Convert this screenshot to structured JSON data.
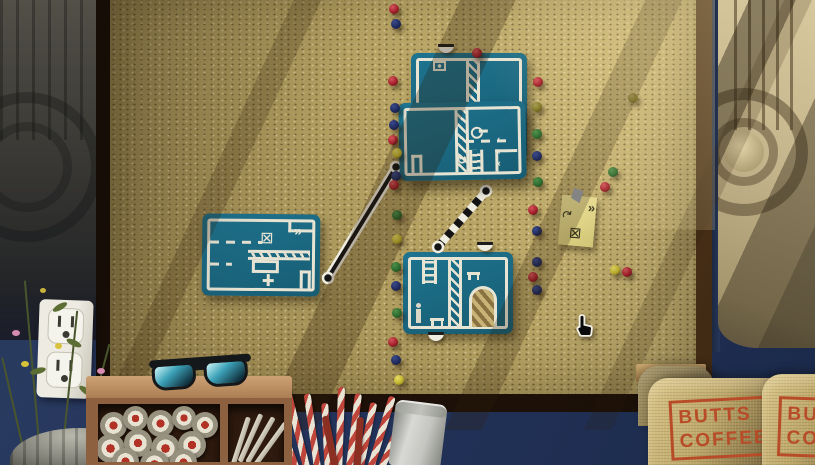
{
  "scene": {
    "name": "corkboard-mission-select",
    "cursor": {
      "x": 572,
      "y": 313,
      "type": "hand-pointer"
    }
  },
  "colors": {
    "cork": "#b8a565",
    "card_teal": "#1b6a83",
    "card_line": "#e8e4d4",
    "wall_navy": "#25355e",
    "frame_wood_dark": "#1a0f07",
    "frame_wood_light": "#6b4a26",
    "note_yellow": "#e6db8e",
    "stamp_red": "#b84c28",
    "pin_red": "#a8222c",
    "pin_blue": "#1f2a5e",
    "pin_green": "#2c6b2f",
    "pin_yellow": "#c2b52e",
    "pin_olive": "#7f7522"
  },
  "icons": {
    "fast_forward": "»",
    "chevron": "‹",
    "rotate_arrow": "↻",
    "curved_arrow": "↷",
    "crossed_box": "⊠"
  },
  "levels": {
    "top_card": {
      "features": [
        "camera-box",
        "hatched-wall"
      ]
    },
    "middle_card": {
      "features": [
        "door",
        "hatched-wall",
        "key",
        "dashed-route",
        "chevrons",
        "rotate-arrow",
        "ladder"
      ]
    },
    "left_card": {
      "features": [
        "dashed-route",
        "crossed-box",
        "fast-forward",
        "hatched-platform",
        "crate",
        "door"
      ]
    },
    "bottom_card": {
      "features": [
        "ladder",
        "hatched-wall",
        "arched-door",
        "agent-figure",
        "bench"
      ]
    }
  },
  "note": {
    "icons": [
      "curved-arrow",
      "fast-forward",
      "crossed-box"
    ]
  },
  "coffee_bag": {
    "line1": "BUTTS",
    "line2": "COFFEE"
  },
  "connectors": {
    "solid": {
      "x1": 328,
      "y1": 278,
      "x2": 396,
      "y2": 167
    },
    "striped": {
      "x1": 438,
      "y1": 247,
      "x2": 486,
      "y2": 191
    }
  },
  "pins": [
    {
      "x": 394,
      "y": 9,
      "c": "red"
    },
    {
      "x": 396,
      "y": 24,
      "c": "blue"
    },
    {
      "x": 393,
      "y": 81,
      "c": "red"
    },
    {
      "x": 395,
      "y": 108,
      "c": "blue"
    },
    {
      "x": 394,
      "y": 125,
      "c": "blue"
    },
    {
      "x": 393,
      "y": 140,
      "c": "red"
    },
    {
      "x": 397,
      "y": 153,
      "c": "yellow"
    },
    {
      "x": 396,
      "y": 176,
      "c": "blue"
    },
    {
      "x": 394,
      "y": 185,
      "c": "red"
    },
    {
      "x": 397,
      "y": 215,
      "c": "green"
    },
    {
      "x": 397,
      "y": 239,
      "c": "yellow"
    },
    {
      "x": 396,
      "y": 267,
      "c": "green"
    },
    {
      "x": 396,
      "y": 286,
      "c": "blue"
    },
    {
      "x": 397,
      "y": 313,
      "c": "green"
    },
    {
      "x": 393,
      "y": 342,
      "c": "red"
    },
    {
      "x": 396,
      "y": 360,
      "c": "blue"
    },
    {
      "x": 399,
      "y": 380,
      "c": "yellow"
    },
    {
      "x": 477,
      "y": 53,
      "c": "red"
    },
    {
      "x": 538,
      "y": 82,
      "c": "red"
    },
    {
      "x": 537,
      "y": 107,
      "c": "olive"
    },
    {
      "x": 537,
      "y": 134,
      "c": "green"
    },
    {
      "x": 537,
      "y": 156,
      "c": "blue"
    },
    {
      "x": 538,
      "y": 182,
      "c": "green"
    },
    {
      "x": 533,
      "y": 210,
      "c": "red"
    },
    {
      "x": 537,
      "y": 231,
      "c": "blue"
    },
    {
      "x": 537,
      "y": 262,
      "c": "blue"
    },
    {
      "x": 533,
      "y": 277,
      "c": "red"
    },
    {
      "x": 537,
      "y": 290,
      "c": "blue"
    },
    {
      "x": 633,
      "y": 98,
      "c": "olive"
    },
    {
      "x": 613,
      "y": 172,
      "c": "green"
    },
    {
      "x": 605,
      "y": 187,
      "c": "red"
    },
    {
      "x": 615,
      "y": 270,
      "c": "yellow"
    },
    {
      "x": 627,
      "y": 272,
      "c": "red"
    }
  ]
}
